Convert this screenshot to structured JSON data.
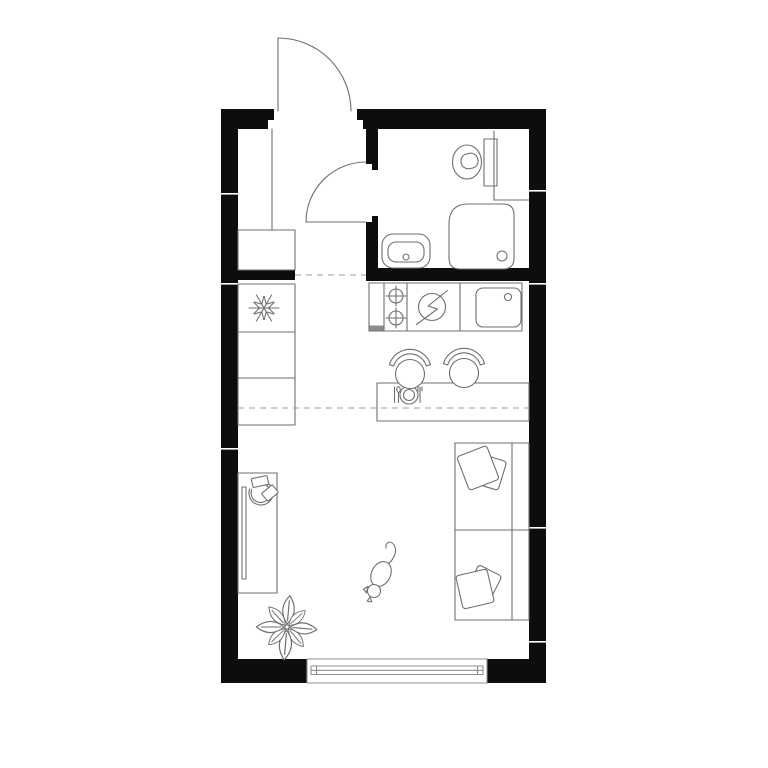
{
  "page": {
    "title": "Studio apartment floor plan"
  },
  "colors": {
    "background": "#ffffff",
    "wall": "#0d0d0d",
    "line": "#6f6f6f",
    "line_soft": "#8f8f8f",
    "dashed": "#9e9e9e",
    "counter_end_cap": "#8c8c8c"
  },
  "plan": {
    "rooms": [
      {
        "name": "entry-hall"
      },
      {
        "name": "bathroom"
      },
      {
        "name": "kitchen-living-area"
      }
    ],
    "fixtures": [
      "entry-door",
      "wardrobe",
      "bathroom-door",
      "toilet",
      "shower",
      "bathroom-sink",
      "refrigerator",
      "kitchen-cabinets",
      "cooktop-burners",
      "electric-stove-symbol",
      "kitchen-sink",
      "dining-table",
      "dining-chair-left",
      "dining-chair-right",
      "sofa-bed",
      "sofa-pillow-top",
      "sofa-pillow-bottom",
      "desk",
      "monitor",
      "office-chair",
      "plant",
      "cat",
      "window"
    ]
  }
}
